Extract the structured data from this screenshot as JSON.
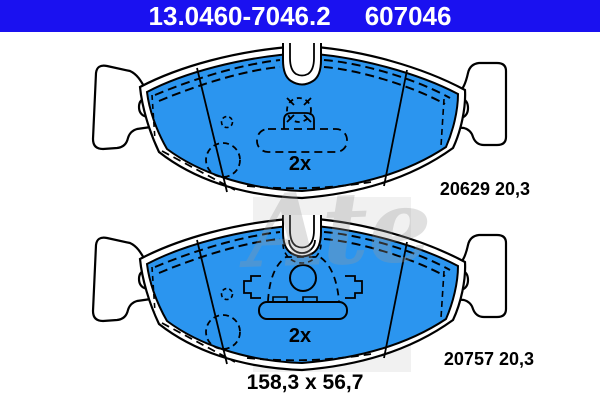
{
  "header": {
    "oe_number": "13.0460-7046.2",
    "catalog_number": "607046"
  },
  "pads": [
    {
      "quantity": "2x",
      "wva": "20629 20,3"
    },
    {
      "quantity": "2x",
      "wva": "20757 20,3"
    }
  ],
  "dimensions_label": "158,3 x 56,7",
  "watermark": {
    "brand": "Ate"
  },
  "colors": {
    "header_bg": "#1a11f0",
    "header_text": "#ffffff",
    "pad_fill": "#2b95ef",
    "ink": "#000000",
    "watermark_gray": "#9a9a9a"
  }
}
